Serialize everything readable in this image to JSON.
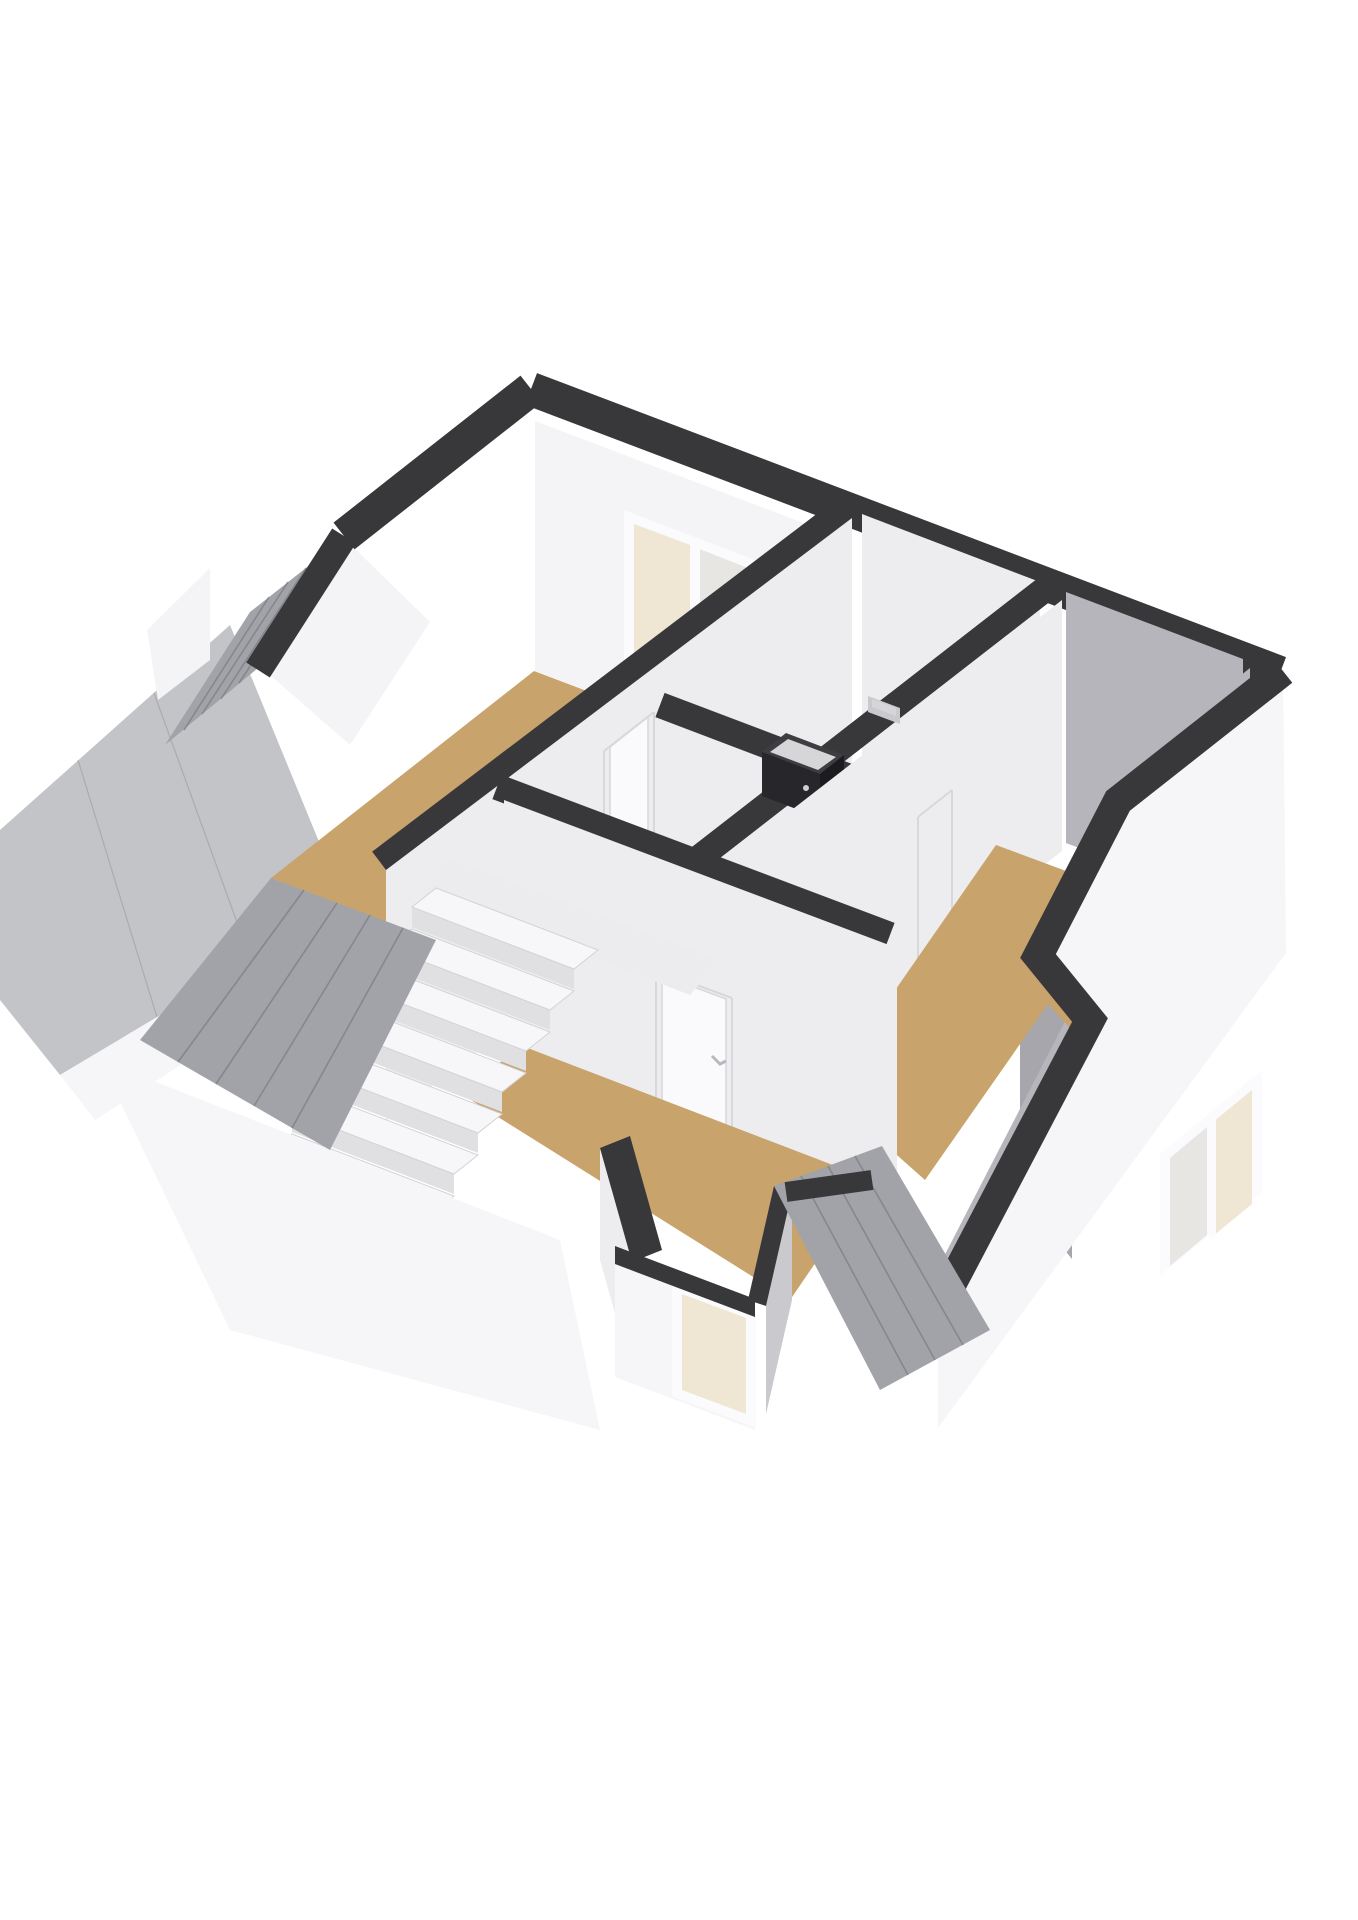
{
  "page": {
    "background": "#ffffff",
    "content": "3D axonometric floor-plan render of an attic / upper floor, no visible text labels"
  },
  "colors": {
    "bg": "#ffffff",
    "band": "#38383b",
    "floor_tan": "#c8a36c",
    "floor_gray": "#b9b9bf",
    "hall_floor": "#ececef",
    "wall_white": "#f4f4f6",
    "wall_light": "#ededf0",
    "wall_mid": "#c9c9ce",
    "wall_gray": "#b5b5bb",
    "wall_dark": "#a6a6ac",
    "roof_plank": "#a2a3a8",
    "roof_smooth": "#c3c4c8",
    "roof_seam": "#7e7f84",
    "white_ext": "#f6f6f8",
    "win_frame": "#fbfbfd",
    "glass_warm": "#efe7d4",
    "glass_cool": "#e7e6e2",
    "stair_top": "#f7f7f9",
    "stair_riser": "#e0e0e3",
    "stair_edge": "#d3d3d7",
    "boiler": "#27272b",
    "boiler_side": "#1c1c20",
    "boiler_top": "#3d3d42",
    "boiler_metal": "#d6d6d9",
    "door_leaf": "#fafafc",
    "door_frame": "#d8d8dc"
  },
  "floor_plan": {
    "view": "3d-isometric-cutaway",
    "wall_top_color_key": "band",
    "rooms": [
      {
        "id": "bedroom-top-left",
        "floor": "tan",
        "features": [
          "sliding-window-2-pane",
          "sloped-roof-side"
        ]
      },
      {
        "id": "technical-room-center",
        "floor": "gray",
        "features": [
          "boiler-unit",
          "wall-meter"
        ]
      },
      {
        "id": "bedroom-right",
        "floor": "tan",
        "features": [
          "exterior-window-2-pane",
          "sloped-wall-cut"
        ]
      },
      {
        "id": "bedroom-bottom-left",
        "floor": "tan",
        "features": [
          "interior-door",
          "dormer-window"
        ]
      },
      {
        "id": "landing-hall",
        "floor": "light",
        "features": [
          "staircase-opening",
          "door-to-top-left-room"
        ]
      }
    ],
    "staircase": {
      "visible_steps": 9,
      "descends_towards": "lower-left"
    },
    "windows": [
      {
        "id": "window-top-left",
        "panes": 2
      },
      {
        "id": "window-right-exterior",
        "panes": 2
      },
      {
        "id": "window-dormer-bottom",
        "panes": 1
      }
    ],
    "roof_surfaces": [
      {
        "id": "roof-left-upper-plank",
        "texture": "planks"
      },
      {
        "id": "roof-left-lower-smooth",
        "texture": "smooth"
      },
      {
        "id": "roof-bottom-left-plank",
        "texture": "planks"
      },
      {
        "id": "roof-bottom-right-plank",
        "texture": "planks"
      }
    ]
  }
}
